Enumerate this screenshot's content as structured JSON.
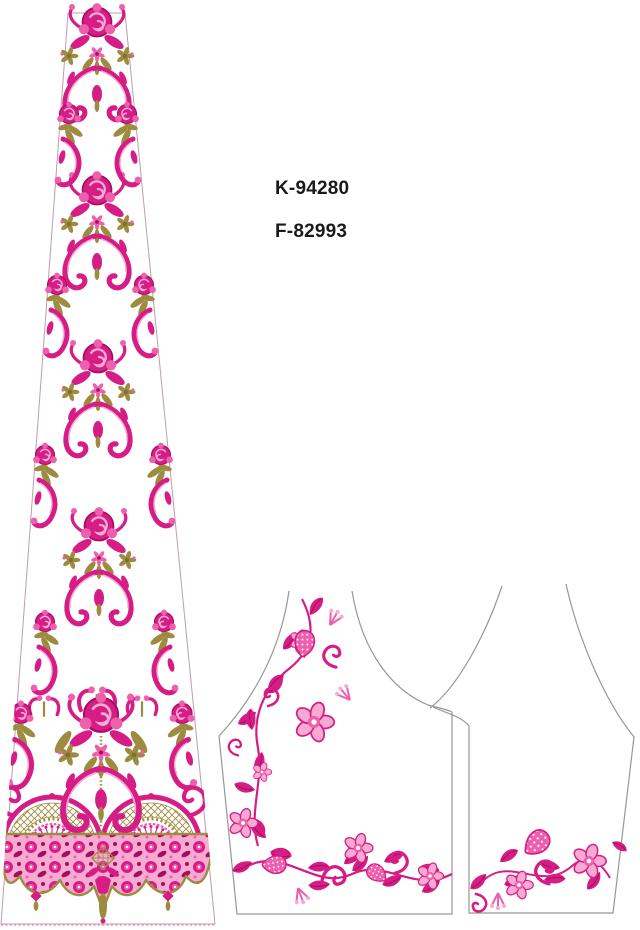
{
  "page": {
    "width": 640,
    "height": 930,
    "background": "#ffffff"
  },
  "annotations": {
    "code_top": "K-94280",
    "code_bottom": "F-82993"
  },
  "artwork": {
    "left_piece": {
      "name": "lehenga-kali-panel",
      "description": "tall tapered skirt panel with repeating pink-and-gold damask motifs and an ornate lace border with lattice swags and scalloped hem"
    },
    "right_piece": {
      "name": "blouse-pattern",
      "description": "blouse front and back outlines with pink floral vine embroidery along the neckline side and hems"
    }
  },
  "colors": {
    "background": "#ffffff",
    "text": "#1a1a1a",
    "pink_deep": "#d61d86",
    "pink_dark": "#a50d5e",
    "pink_mid": "#ee5fae",
    "pink_light": "#f7aad2",
    "pink_pale": "#fcdcee",
    "gold": "#9d8c3f",
    "gold_dark": "#7e7030",
    "outline_gray": "#979797",
    "panel_outline": "#c09cae",
    "hem_line": "#ef8fc0"
  }
}
